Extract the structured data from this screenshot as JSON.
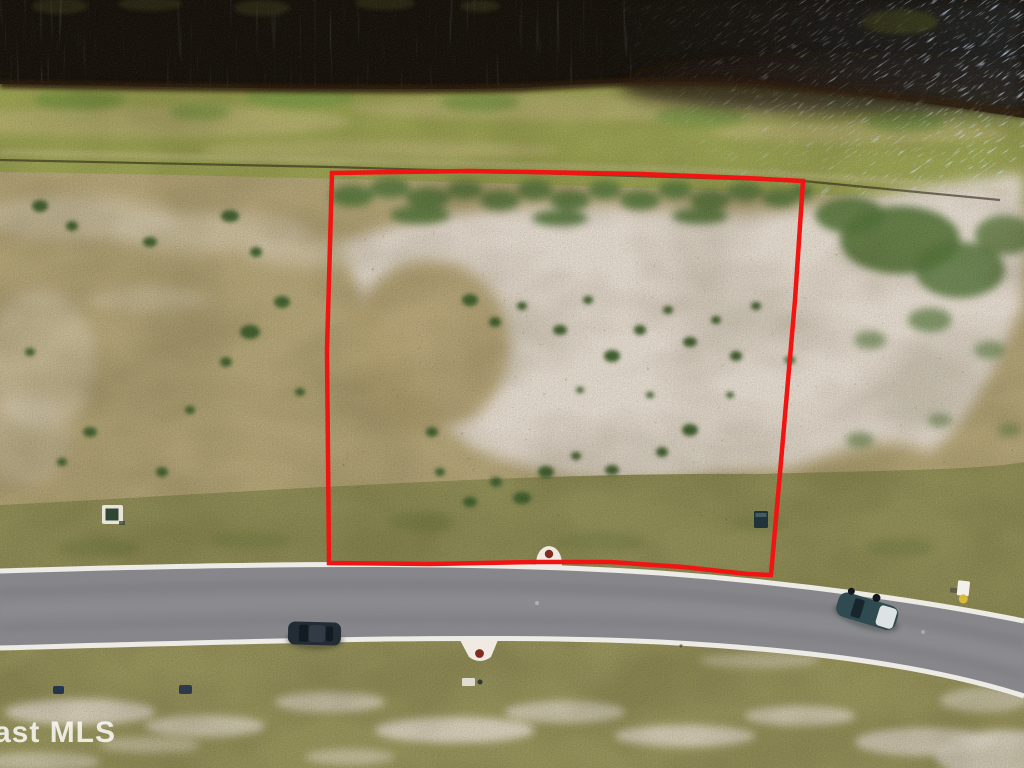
{
  "watermark": {
    "text": "ast MLS"
  },
  "scene": {
    "description": "Aerial drone photo of a cleared vacant residential lot outlined in red, between a dark lake at top and a curved asphalt street below"
  },
  "palette": {
    "water": "#16110b",
    "water_glint": "#cfdde6",
    "water_wash": "#3d4a52",
    "shoreline": "#2f1d0d",
    "shore_grass": "#99a051",
    "dry_field": "#b2a376",
    "lot_sand": "#e3d9cd",
    "lot_patch": "#b4a273",
    "scrub_green": "#57763c",
    "scrub_dark": "#3f5e2e",
    "frontage_grass": "#8e8c55",
    "road_asphalt": "#87878b",
    "road_curb": "#edebe5",
    "lot_boundary_red": "#f01512",
    "lower_grass": "#95915a",
    "marker_base": "#f0eae2",
    "marker_dot": "#7e2d20",
    "car_dark": "#232c35",
    "car_teal": "#2f4a50",
    "car_white_panel": "#dde3e3",
    "sign_face": "#f2f0ea",
    "sign_base": "#d8b93a",
    "utility_pad": "#e8e4da",
    "utility_lid": "#2e4633",
    "utility_box": "#20323a",
    "watermark_fill": "#ffffff"
  },
  "features": {
    "lake": "dark lake water with sun glint at upper right",
    "shoreline": "dark brown bank edge between water and grass",
    "shore_grass": "green grass strip along the lake bank",
    "vacant_lot": "cleared sandy lot with scattered scrub",
    "lot_boundary": "red property-line outline drawn over the lot",
    "street": "curved gray asphalt street with white edge stripes",
    "driveway_marker_top": "white culvert marker with red cap on the lot frontage",
    "driveway_marker_bottom": "white culvert marker with red cap across the street",
    "car_dark": "dark car parked along the street at left",
    "car_teal": "teal car with white panel on the street at right",
    "street_sign": "small roadside sign on the right shoulder",
    "utility_pad_left": "small utility pad in the field left of the lot",
    "utility_box_right": "dark utility box inside the lot near the street"
  }
}
